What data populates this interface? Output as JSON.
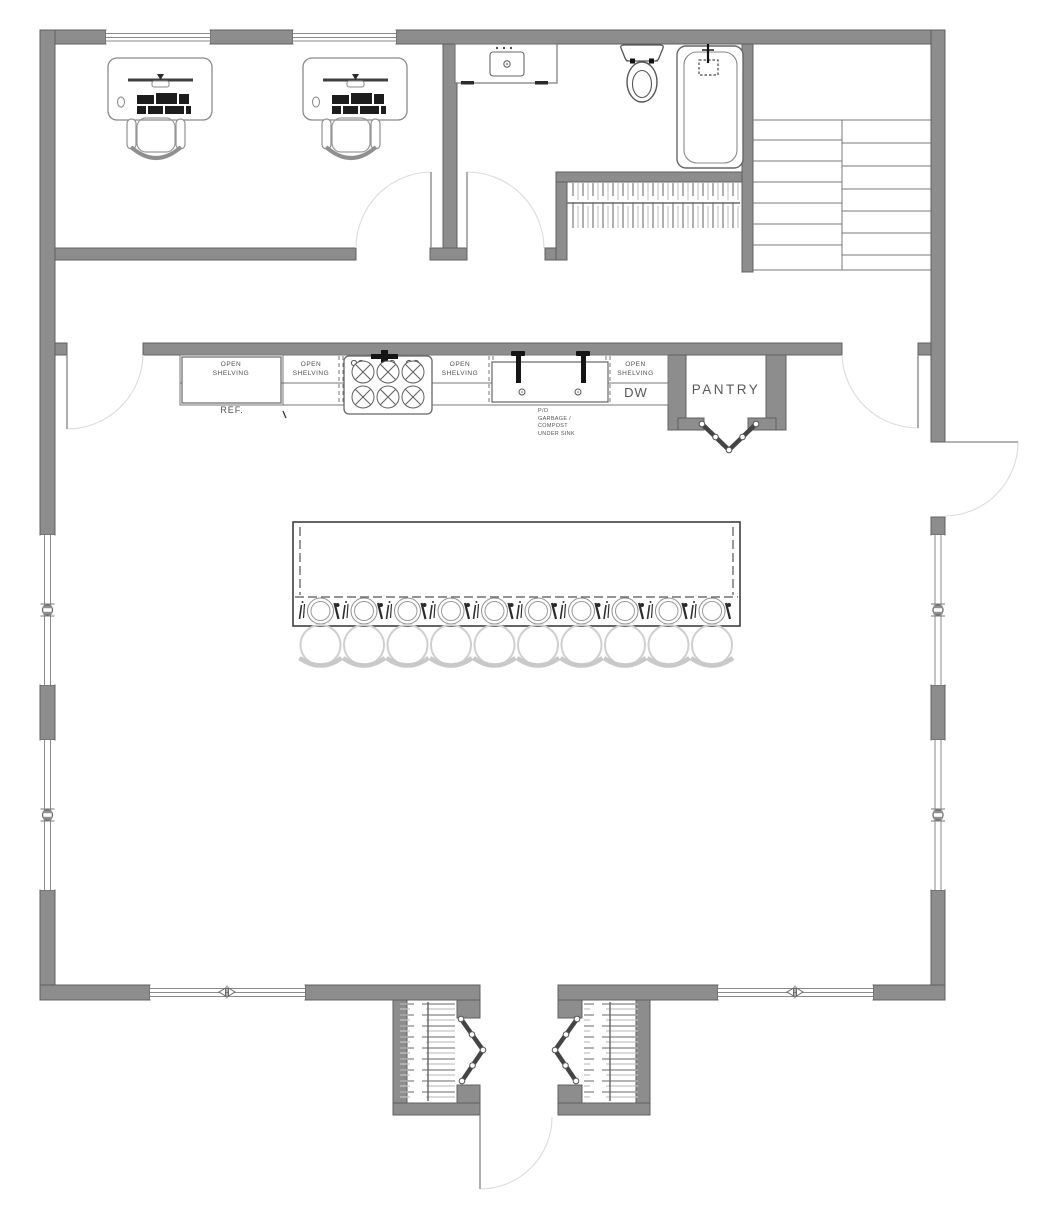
{
  "plan": {
    "type": "architectural-floor-plan",
    "labels": {
      "open_shelving": "OPEN\nSHELVING",
      "ref": "REF.",
      "dw": "DW",
      "pantry": "PANTRY",
      "sink_note": "P/O\nGARBAGE /\nCOMPOST\nUNDER SINK"
    },
    "counts": {
      "open_shelving_sections": 4,
      "island_place_settings": 10,
      "island_bar_stools": 10,
      "office_desks": 2,
      "closets_with_hanging_rods": 3,
      "exterior_windows": 8,
      "door_swings": 6
    },
    "rooms_and_fixtures": [
      "office-with-two-desks",
      "bathroom-vanity-sink",
      "toilet",
      "bathtub",
      "hall-closet",
      "staircase",
      "kitchen-counter",
      "refrigerator",
      "range-cooktop-6-burner",
      "kitchen-sink",
      "dishwasher",
      "pantry-with-bifold-doors",
      "kitchen-island",
      "entry-vestibule",
      "entry-closets-with-bifold-doors",
      "front-door"
    ],
    "colors": {
      "background": "#ffffff",
      "wall_fill": "#8d8d8d",
      "wall_outline": "#606060",
      "line": "#666666",
      "light_gray": "#cccccc",
      "text": "#4e4e4e"
    }
  }
}
